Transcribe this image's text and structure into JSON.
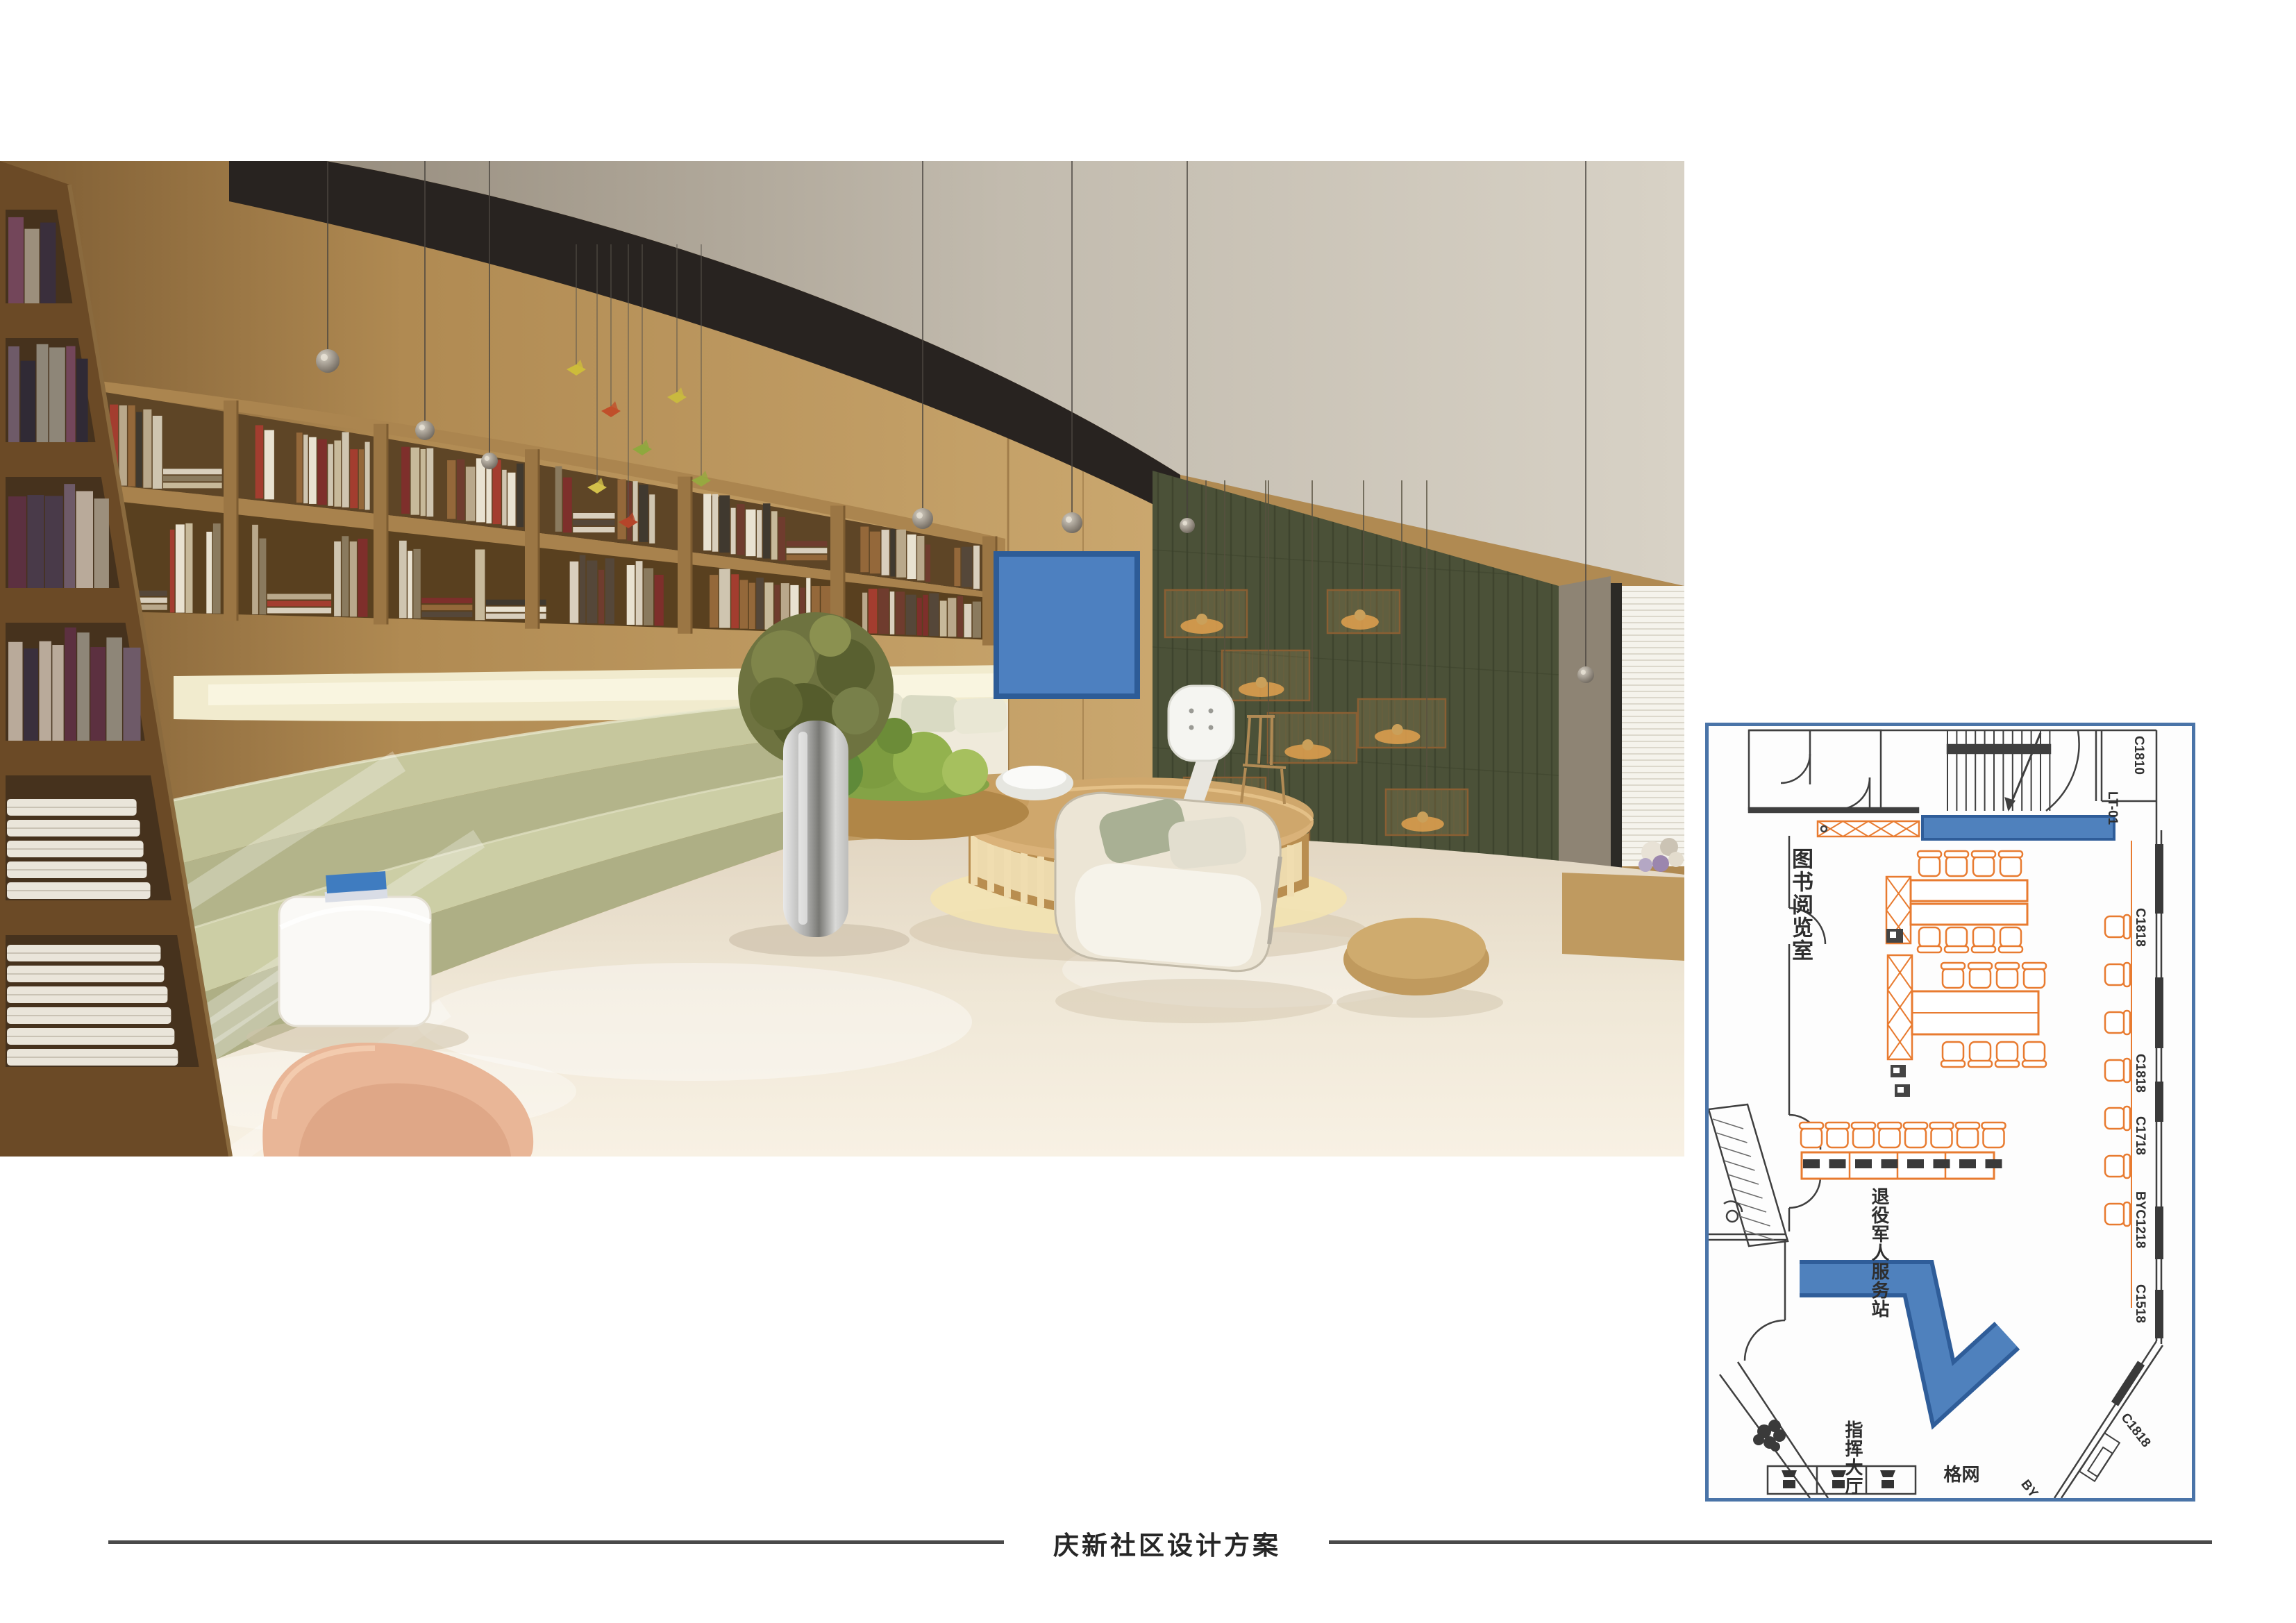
{
  "title": {
    "text": "庆新社区设计方案"
  },
  "photo": {
    "description": "library-reading-room-rendering",
    "overlay_fill": "#4d80c0",
    "overlay_border": "#2d5c97"
  },
  "floor_plan": {
    "border_color": "#4a74a8",
    "furniture_color": "#e87b30",
    "highlight_fill": "#4f81bd",
    "highlight_border": "#2f5d99",
    "room_label": "图书阅览室",
    "area_label": "退役军人服务站",
    "hall_label": "指挥大厅",
    "grid_label": "网格",
    "wall_labels": [
      "C1810",
      "LT-01",
      "C1818",
      "C1818",
      "C1718",
      "BYC1218",
      "C1518",
      "C1818",
      "BY"
    ]
  }
}
